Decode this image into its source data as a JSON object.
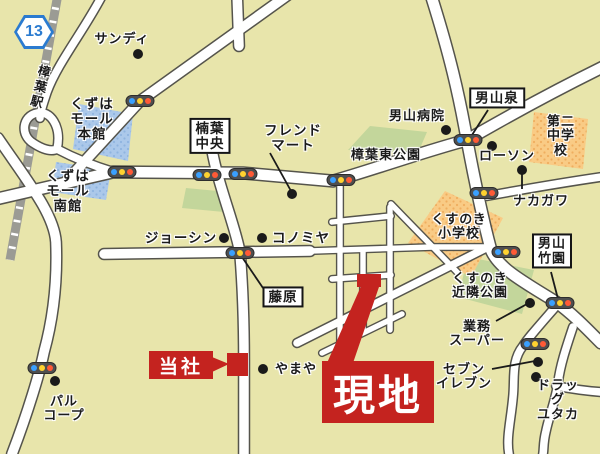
{
  "map": {
    "route_badge": "13",
    "labels": {
      "sandy": "サンディ",
      "kuzuha_station": "樟葉駅",
      "mall_main": "くずは\nモール\n本館",
      "mall_south": "くずは\nモール\n南館",
      "kuzuha_chuo": "楠葉\n中央",
      "friend_mart": "フレンド\nマート",
      "higashi_park": "樟葉東公園",
      "hospital": "男山病院",
      "izumi": "男山泉",
      "lawson": "ローソン",
      "daini_chugakko": "第二\n中学校",
      "nakagawa": "ナカガワ",
      "kusunoki_shogakko": "くすのき\n小学校",
      "takezono": "男山\n竹園",
      "kinrin_park": "くすのき\n近隣公園",
      "gyomu_super": "業務\nスーパー",
      "seven_eleven": "セブン\nイレブン",
      "drug_yutaka": "ドラッグ\nユタカ",
      "joshin": "ジョーシン",
      "konomiya": "コノミヤ",
      "fujiwara": "藤原",
      "yamaya": "やまや",
      "palcoop": "パル\nコープ",
      "tosha": "当社",
      "genchi": "現地"
    },
    "colors": {
      "background": "#e8e5ab",
      "road_fill": "#ffffff",
      "road_outline": "#55544c",
      "railway": "#9b9b94",
      "park_green": "#c3d69b",
      "school_orange": "#f9cb85",
      "mall_blue": "#abc8ea",
      "accent_red": "#c4231f",
      "route_badge_blue": "#2b7bd0",
      "signal_blue": "#3aa0ff",
      "signal_yellow": "#ffd230",
      "signal_red": "#ff5a36"
    },
    "icons": {
      "traffic_light": "pill with blue/yellow/red dots",
      "poi": "black dot",
      "site_marker": "red rectangle with arrow"
    }
  }
}
